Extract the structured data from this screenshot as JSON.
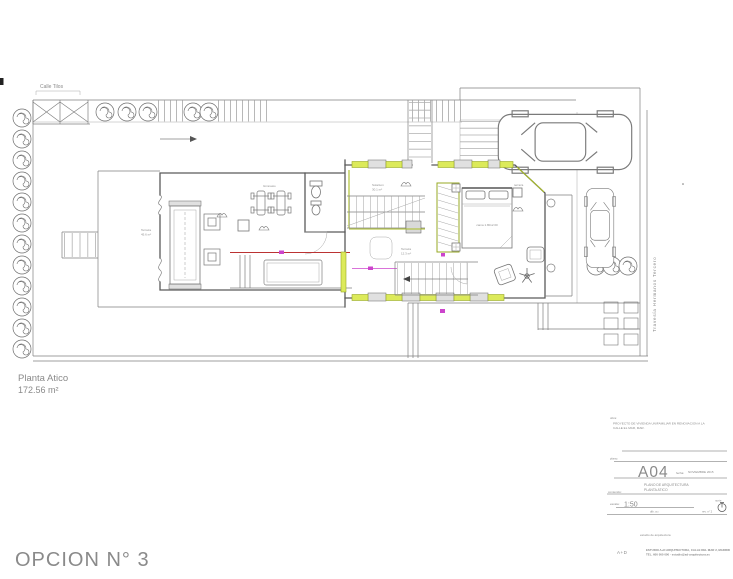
{
  "sheet": {
    "floor_label": "Planta Atico",
    "floor_area": "172.56 m²",
    "option_title": "OPCION N° 3"
  },
  "site": {
    "street_top": "Calle Tilos",
    "street_right": "Travesía Hermanos Tercero"
  },
  "plan_labels": {
    "terraza_oeste": "Terraza",
    "terraza_oeste_area": "45.6 m²",
    "gimnasio": "Gimnasio",
    "solarium": "Solarium",
    "solarium_area": "30.1 m²",
    "terraza_sur": "Terraza",
    "terraza_sur_area": "12.3 m²",
    "cama": "cama 1.80x2.00",
    "terraza_este": "terraza"
  },
  "titleblock": {
    "obra_label": "obra:",
    "obra_line1": "PROYECTO DE VIVIENDA UNIFAMILIAR EN RENOVACION A LA",
    "obra_line2": "CALLE EL MAR, MAR.",
    "plano_label": "plano:",
    "sheet_number": "A04",
    "fecha_label": "fecha:",
    "fecha_value": "NOVIEMBRE 2015",
    "contenido_label": "contenido:",
    "contenido_line1": "PLANO DE ARQUITECTURA",
    "contenido_line2": "PLANTA ATICO",
    "escala_label": "escala:",
    "escala_value": "1:50",
    "norte_label": "norte",
    "dib_label": "dib. a.r.",
    "rev_label": "rev. n° 2",
    "studio_line": "estudio de arquitectura",
    "logo_text": "A+D",
    "address_line1": "ESTUDIO A+D ARQUITECTURA, CALLE DEL MAR 2, MADRID",
    "address_line2": "TEL. 600 000 000 · estudio@ad-arquitectura.es"
  }
}
